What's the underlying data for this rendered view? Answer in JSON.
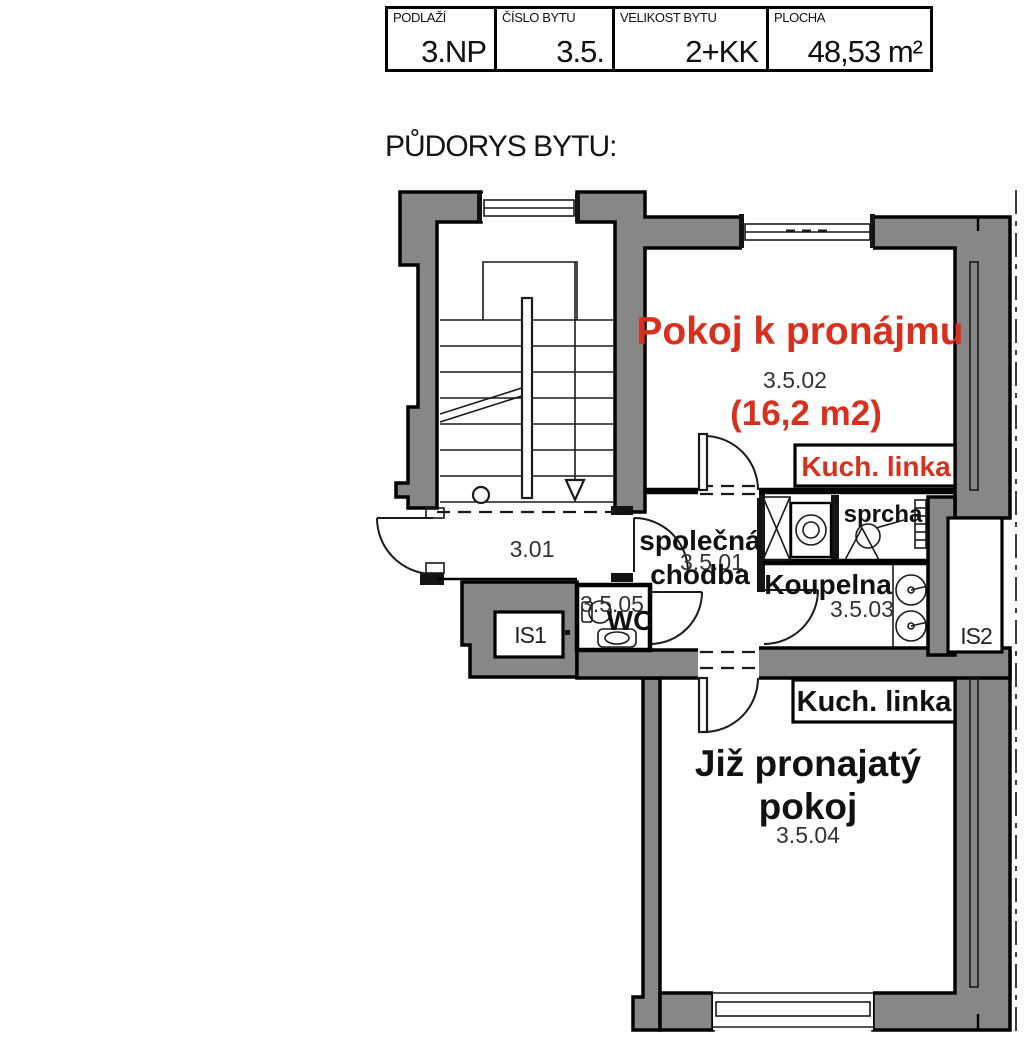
{
  "header": {
    "cells": [
      {
        "label": "PODLAŽÍ",
        "value": "3.NP"
      },
      {
        "label": "ČÍSLO BYTU",
        "value": "3.5."
      },
      {
        "label": "VELIKOST BYTU",
        "value": "2+KK"
      },
      {
        "label": "PLOCHA",
        "value": "48,53 m²"
      }
    ]
  },
  "title": "PŮDORYS BYTU:",
  "plan": {
    "room_for_rent": {
      "name": "Pokoj k pronájmu",
      "number": "3.5.02",
      "area": "(16,2 m2)",
      "kitchen": "Kuch. linka"
    },
    "staircase_corridor": {
      "number": "3.01"
    },
    "shared_hall": {
      "line1": "společná",
      "line2": "chodba",
      "number": "3.5.01"
    },
    "wc": {
      "name": "WC",
      "number": "3.5.05"
    },
    "bathroom": {
      "name": "Koupelna",
      "number": "3.5.03"
    },
    "shower": {
      "name": "sprcha"
    },
    "utility1": {
      "name": "IS1"
    },
    "utility2": {
      "name": "IS2"
    },
    "rented_room": {
      "line1": "Již pronajatý",
      "line2": "pokoj",
      "number": "3.5.04",
      "kitchen": "Kuch. linka"
    },
    "colors": {
      "wall": "#878787",
      "accent_red": "#d9301d"
    }
  }
}
